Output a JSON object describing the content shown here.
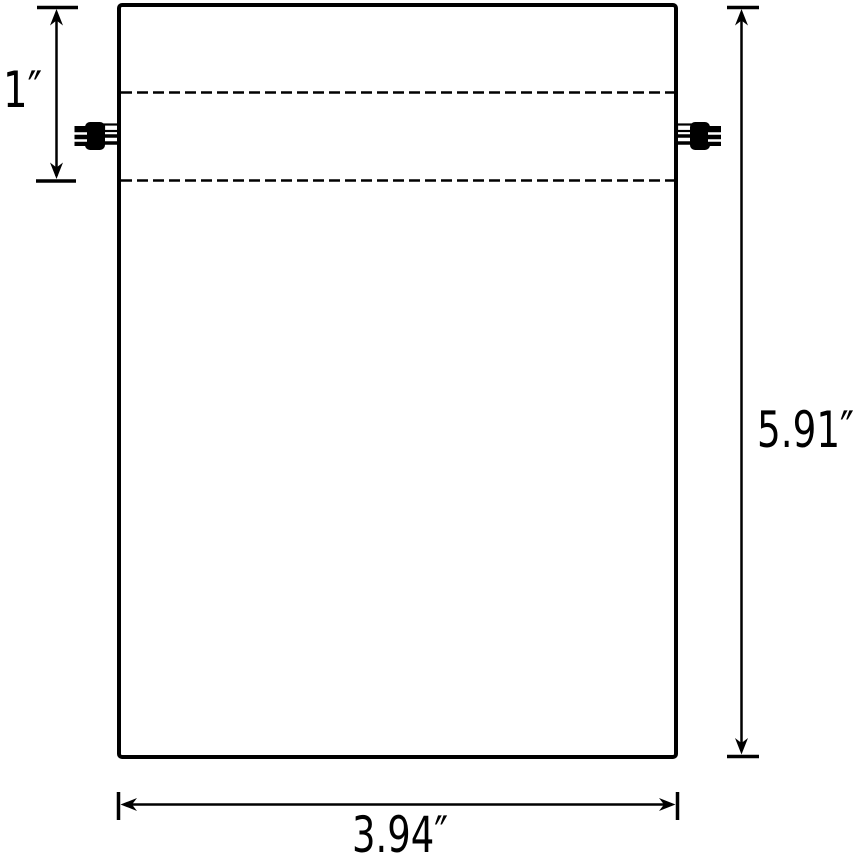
{
  "page": {
    "background": "#ffffff"
  },
  "diagram": {
    "object": "drawstring-bag-dimension-drawing",
    "colors": {
      "line": "#000000",
      "toggle_fill": "#000000",
      "background": "#ffffff"
    },
    "dimensions": {
      "hem_depth": {
        "label": "1″"
      },
      "bag_height": {
        "label": "5.91″"
      },
      "bag_width": {
        "label": "3.94″"
      }
    }
  }
}
